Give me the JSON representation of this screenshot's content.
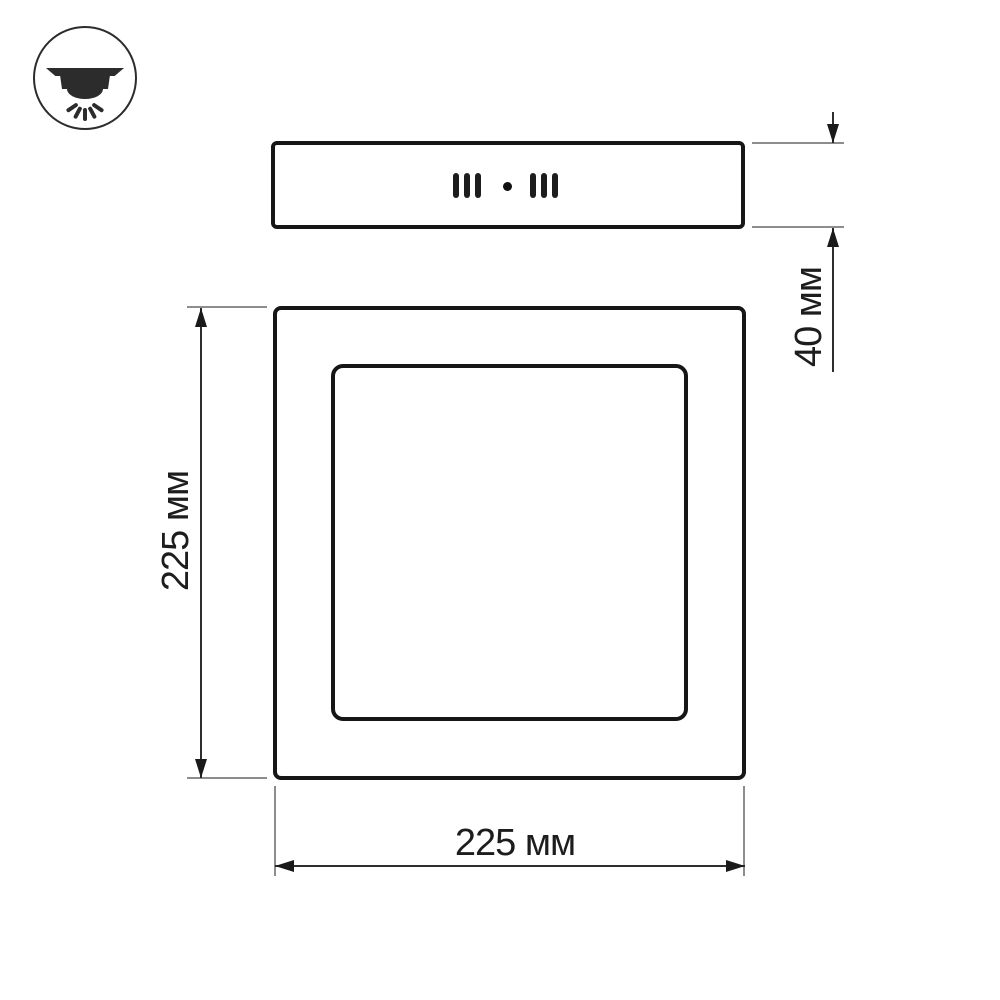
{
  "page": {
    "type": "technical-drawing",
    "background": "#ffffff"
  },
  "icon": {
    "name": "ceiling-surface-downlight-icon"
  },
  "views": {
    "side": {
      "name": "side-view",
      "features": [
        "vent-slots-left",
        "center-hole",
        "vent-slots-right"
      ]
    },
    "front": {
      "name": "front-view",
      "parts": [
        "outer-frame",
        "inner-light-panel"
      ]
    }
  },
  "dimensions": {
    "height": {
      "label": "225 мм",
      "value": 225,
      "unit": "мм",
      "orientation": "vertical-left"
    },
    "width": {
      "label": "225 мм",
      "value": 225,
      "unit": "мм",
      "orientation": "horizontal-bottom"
    },
    "depth": {
      "label": "40 мм",
      "value": 40,
      "unit": "мм",
      "orientation": "vertical-right"
    }
  },
  "colors": {
    "outline": "#161616",
    "dimension_line": "#2e2e2e",
    "extension_line": "#8d8d8d",
    "arrow": "#1a1a1a",
    "text": "#1d1d1d",
    "background": "#ffffff"
  }
}
